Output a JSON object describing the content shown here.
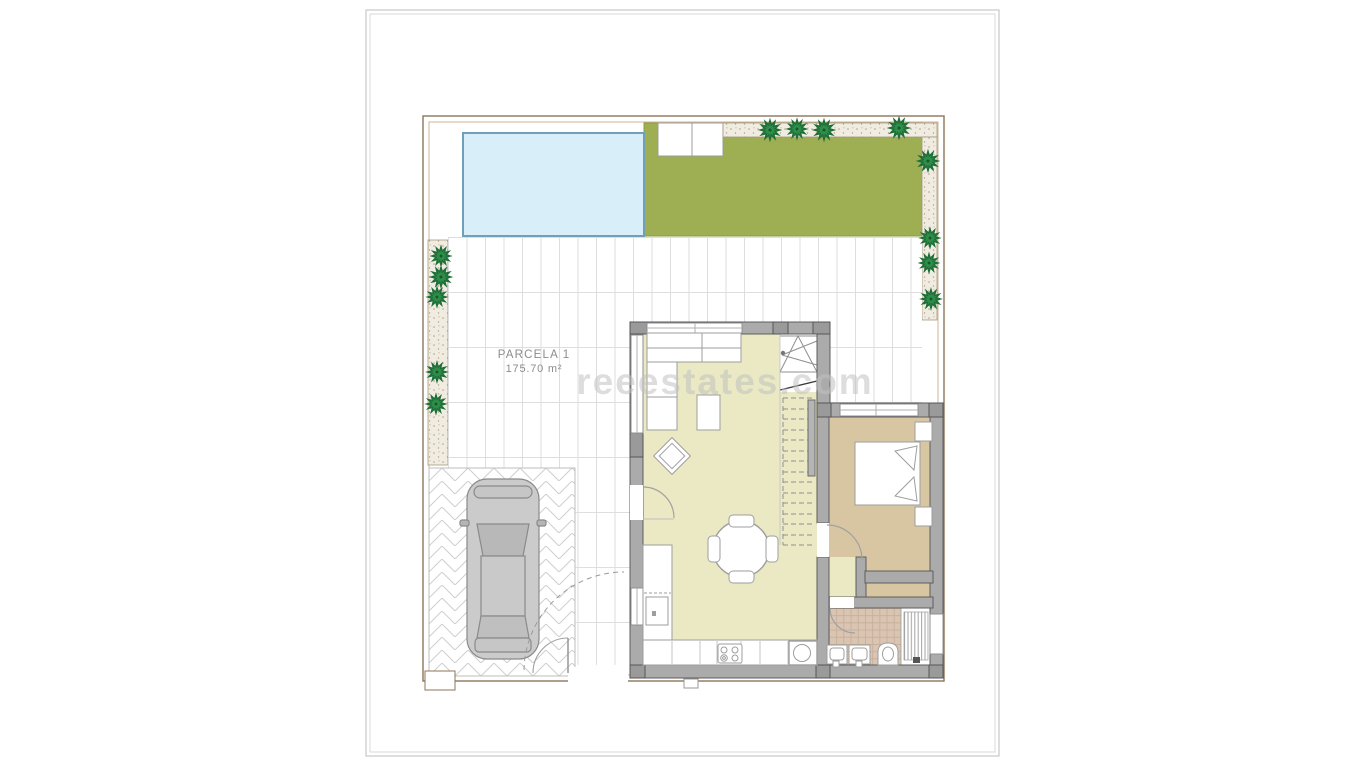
{
  "plan": {
    "parcel_label": "PARCELA 1",
    "area_label": "175.70 m²",
    "watermark_text": "reeestates.com"
  },
  "colors": {
    "lawn": "#9dae53",
    "pool_fill": "#d8effa",
    "pool_border": "#6f9fb9",
    "wall": "#ababab",
    "wall_dark_block": "#9a9a9a",
    "living_floor": "#eae9c4",
    "bedroom_floor": "#d8c6a2",
    "bathroom_tile": "#dac5b2",
    "gravel": "#f0ece1",
    "tile_grid_line": "#dedede",
    "plot_border": "#8d7458",
    "tree_green": "#1e6e38",
    "car_body": "#cbcbcb",
    "furniture_line": "#9a9a9a",
    "label_text": "#8c8c8c",
    "watermark": "#c2c2c2"
  }
}
